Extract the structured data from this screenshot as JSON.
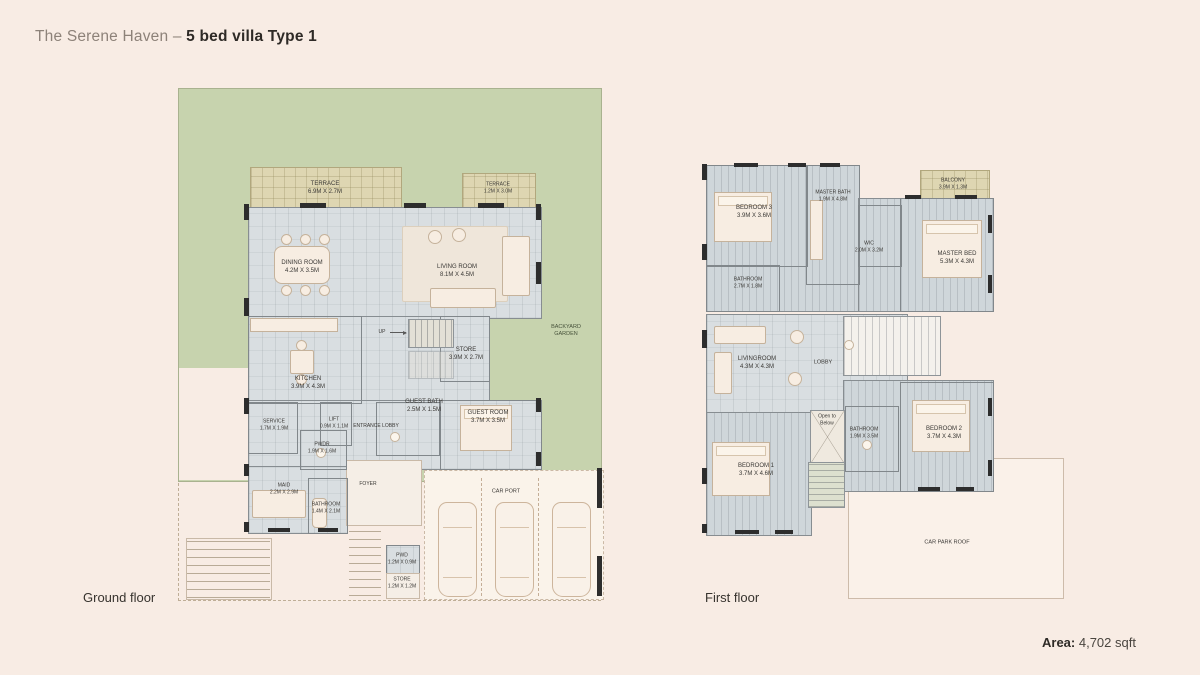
{
  "title": {
    "prefix": "The Serene Haven – ",
    "bold": "5 bed villa Type 1"
  },
  "area": {
    "label": "Area:",
    "value": " 4,702 sqft"
  },
  "colors": {
    "background": "#f8ece4",
    "garden_green": "#c7d3ae",
    "terrace_tan": "#ded6b2",
    "floor_gray": "#d9dee1",
    "wall_dark": "#2d2d2d"
  },
  "ground": {
    "caption": "Ground floor",
    "garden": {
      "line1": "BACKYARD",
      "line2": "GARDEN"
    },
    "up": "UP",
    "entrance_lobby": "ENTRANCE LOBBY",
    "foyer": "FOYER",
    "car_port": "CAR PORT",
    "rooms": [
      {
        "name": "TERRACE",
        "dims": "6.9M X 2.7M"
      },
      {
        "name": "TERRACE",
        "dims": "1.2M X 3.0M"
      },
      {
        "name": "DINING ROOM",
        "dims": "4.2M X 3.5M"
      },
      {
        "name": "LIVING ROOM",
        "dims": "8.1M X 4.5M"
      },
      {
        "name": "KITCHEN",
        "dims": "3.9M X 4.3M"
      },
      {
        "name": "STORE",
        "dims": "3.9M X 2.7M"
      },
      {
        "name": "SERVICE",
        "dims": "1.7M X 1.9M"
      },
      {
        "name": "LIFT",
        "dims": "0.9M X 1.1M"
      },
      {
        "name": "PWDR",
        "dims": "1.9M X 1.6M"
      },
      {
        "name": "GUEST BATH",
        "dims": "2.5M X 1.5M"
      },
      {
        "name": "GUEST ROOM",
        "dims": "3.7M X 3.5M"
      },
      {
        "name": "MAID",
        "dims": "2.2M X 2.9M"
      },
      {
        "name": "BATHROOM",
        "dims": "1.4M X 2.1M"
      },
      {
        "name": "PWD",
        "dims": "1.2M X 0.9M"
      },
      {
        "name": "STORE",
        "dims": "1.2M X 1.2M"
      }
    ]
  },
  "first": {
    "caption": "First floor",
    "lobby": "LOBBY",
    "open_to_below": {
      "line1": "Open to",
      "line2": "Below"
    },
    "car_park_roof": "CAR PARK ROOF",
    "rooms": [
      {
        "name": "BEDROOM 3",
        "dims": "3.9M X 3.6M"
      },
      {
        "name": "MASTER BATH",
        "dims": "1.9M X 4.8M"
      },
      {
        "name": "BALCONY",
        "dims": "3.9M X 1.3M"
      },
      {
        "name": "WIC",
        "dims": "2.0M X 3.2M"
      },
      {
        "name": "MASTER BED",
        "dims": "5.3M X 4.3M"
      },
      {
        "name": "BATHROOM",
        "dims": "2.7M X 1.8M"
      },
      {
        "name": "LIVINGROOM",
        "dims": "4.3M X 4.3M"
      },
      {
        "name": "BATHROOM",
        "dims": "1.9M X 3.5M"
      },
      {
        "name": "BEDROOM 2",
        "dims": "3.7M X 4.3M"
      },
      {
        "name": "BEDROOM 1",
        "dims": "3.7M X 4.6M"
      }
    ]
  }
}
